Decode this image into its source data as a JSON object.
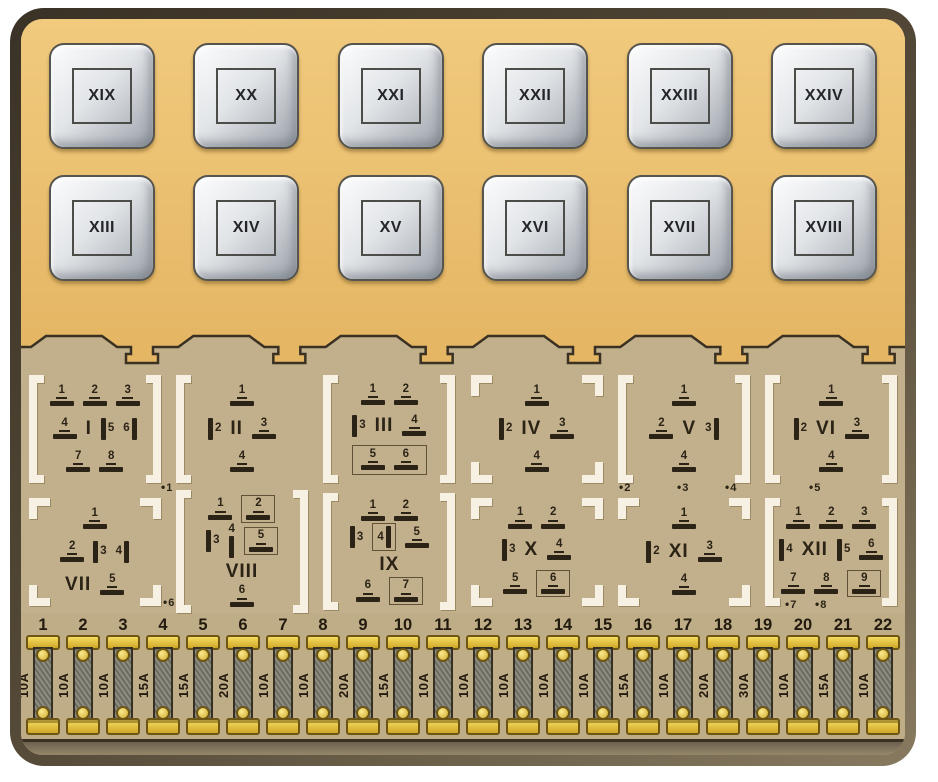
{
  "panel": {
    "relays": {
      "row1": [
        "XIX",
        "XX",
        "XXI",
        "XXII",
        "XXIII",
        "XXIV"
      ],
      "row2": [
        "XIII",
        "XIV",
        "XV",
        "XVI",
        "XVII",
        "XVIII"
      ]
    },
    "connectors": [
      {
        "label": "I",
        "bracket": "full",
        "rows": [
          {
            "pins": [
              {
                "n": "1"
              },
              {
                "n": "2"
              },
              {
                "n": "3"
              }
            ]
          },
          {
            "pins": [
              {
                "n": "4"
              },
              {
                "roman": true
              },
              {
                "n": "5",
                "v": "l"
              },
              {
                "n": "6",
                "v": "r"
              }
            ]
          },
          {
            "pins": [
              {
                "n": "7"
              },
              {
                "n": "8"
              }
            ]
          }
        ]
      },
      {
        "label": "II",
        "bracket": "left",
        "rows": [
          {
            "pins": [
              {
                "n": "1"
              }
            ]
          },
          {
            "pins": [
              {
                "n": "2",
                "v": "l"
              },
              {
                "roman": true
              },
              {
                "n": "3"
              }
            ]
          },
          {
            "pins": [
              {
                "n": "4"
              }
            ]
          }
        ]
      },
      {
        "label": "III",
        "bracket": "full",
        "rows": [
          {
            "pins": [
              {
                "n": "1"
              },
              {
                "n": "2"
              }
            ]
          },
          {
            "pins": [
              {
                "n": "3",
                "v": "l"
              },
              {
                "roman": true
              },
              {
                "n": "4"
              }
            ]
          },
          {
            "box": true,
            "pins": [
              {
                "n": "5"
              },
              {
                "n": "6"
              }
            ]
          }
        ]
      },
      {
        "label": "IV",
        "bracket": "corners",
        "rows": [
          {
            "pins": [
              {
                "n": "1"
              }
            ]
          },
          {
            "pins": [
              {
                "n": "2",
                "v": "l"
              },
              {
                "roman": true
              },
              {
                "n": "3"
              }
            ]
          },
          {
            "pins": [
              {
                "n": "4"
              }
            ]
          }
        ]
      },
      {
        "label": "V",
        "bracket": "full",
        "rows": [
          {
            "pins": [
              {
                "n": "1"
              }
            ]
          },
          {
            "pins": [
              {
                "n": "2"
              },
              {
                "roman": true
              },
              {
                "n": "3",
                "v": "r"
              }
            ]
          },
          {
            "pins": [
              {
                "n": "4"
              }
            ]
          }
        ]
      },
      {
        "label": "VI",
        "bracket": "full",
        "rows": [
          {
            "pins": [
              {
                "n": "1"
              }
            ]
          },
          {
            "pins": [
              {
                "n": "2",
                "v": "l"
              },
              {
                "roman": true
              },
              {
                "n": "3"
              }
            ]
          },
          {
            "pins": [
              {
                "n": "4"
              }
            ]
          }
        ]
      },
      {
        "label": "VII",
        "bracket": "corners",
        "rows": [
          {
            "pins": [
              {
                "n": "1"
              }
            ]
          },
          {
            "pins": [
              {
                "n": "2"
              },
              {
                "n": "3",
                "v": "l"
              },
              {
                "n": "4",
                "v": "r"
              }
            ]
          },
          {
            "pins": [
              {
                "roman": true
              },
              {
                "n": "5"
              }
            ]
          }
        ]
      },
      {
        "label": "VIII",
        "bracket": "full",
        "rows": [
          {
            "pins": [
              {
                "n": "1"
              },
              {
                "n": "2",
                "boxed": true
              }
            ]
          },
          {
            "pins": [
              {
                "n": "3",
                "v": "l"
              },
              {
                "n": "4",
                "v": "c"
              },
              {
                "n": "5",
                "boxed": true
              }
            ]
          },
          {
            "pins": [
              {
                "roman": true
              }
            ]
          },
          {
            "pins": [
              {
                "n": "6"
              }
            ]
          }
        ]
      },
      {
        "label": "IX",
        "bracket": "full",
        "rows": [
          {
            "pins": [
              {
                "n": "1"
              },
              {
                "n": "2"
              }
            ]
          },
          {
            "pins": [
              {
                "n": "3",
                "v": "l"
              },
              {
                "n": "4",
                "v": "r",
                "boxed": true
              },
              {
                "n": "5"
              }
            ]
          },
          {
            "pins": [
              {
                "roman": true
              }
            ]
          },
          {
            "pins": [
              {
                "n": "6"
              },
              {
                "n": "7",
                "boxed": true
              }
            ]
          }
        ]
      },
      {
        "label": "X",
        "bracket": "corners",
        "rows": [
          {
            "pins": [
              {
                "n": "1"
              },
              {
                "n": "2"
              }
            ]
          },
          {
            "pins": [
              {
                "n": "3",
                "v": "l"
              },
              {
                "roman": true
              },
              {
                "n": "4"
              }
            ]
          },
          {
            "pins": [
              {
                "n": "5"
              },
              {
                "n": "6",
                "boxed": true
              }
            ]
          }
        ]
      },
      {
        "label": "XI",
        "bracket": "corners",
        "rows": [
          {
            "pins": [
              {
                "n": "1"
              }
            ]
          },
          {
            "pins": [
              {
                "n": "2",
                "v": "l"
              },
              {
                "roman": true
              },
              {
                "n": "3"
              }
            ]
          },
          {
            "pins": [
              {
                "n": "4"
              }
            ]
          }
        ]
      },
      {
        "label": "XII",
        "bracket": "full",
        "rows": [
          {
            "pins": [
              {
                "n": "1"
              },
              {
                "n": "2"
              },
              {
                "n": "3"
              }
            ]
          },
          {
            "pins": [
              {
                "n": "4",
                "v": "l"
              },
              {
                "roman": true
              },
              {
                "n": "5",
                "v": "l"
              },
              {
                "n": "6"
              }
            ]
          },
          {
            "pins": [
              {
                "n": "7"
              },
              {
                "n": "8"
              },
              {
                "n": "9",
                "boxed": true
              }
            ]
          }
        ]
      }
    ],
    "markers": [
      {
        "label": "1",
        "x": 140,
        "y": 114
      },
      {
        "label": "2",
        "x": 598,
        "y": 114
      },
      {
        "label": "3",
        "x": 656,
        "y": 114
      },
      {
        "label": "4",
        "x": 704,
        "y": 114
      },
      {
        "label": "5",
        "x": 788,
        "y": 114
      },
      {
        "label": "6",
        "x": 142,
        "y": 229
      },
      {
        "label": "7",
        "x": 764,
        "y": 231
      },
      {
        "label": "8",
        "x": 794,
        "y": 231
      }
    ],
    "fuses": [
      {
        "n": "1",
        "amp": "10A"
      },
      {
        "n": "2",
        "amp": "10A"
      },
      {
        "n": "3",
        "amp": "10A"
      },
      {
        "n": "4",
        "amp": "15A"
      },
      {
        "n": "5",
        "amp": "15A"
      },
      {
        "n": "6",
        "amp": "20A"
      },
      {
        "n": "7",
        "amp": "10A"
      },
      {
        "n": "8",
        "amp": "10A"
      },
      {
        "n": "9",
        "amp": "20A"
      },
      {
        "n": "10",
        "amp": "15A"
      },
      {
        "n": "11",
        "amp": "10A"
      },
      {
        "n": "12",
        "amp": "10A"
      },
      {
        "n": "13",
        "amp": "10A"
      },
      {
        "n": "14",
        "amp": "10A"
      },
      {
        "n": "15",
        "amp": "10A"
      },
      {
        "n": "16",
        "amp": "15A"
      },
      {
        "n": "17",
        "amp": "10A"
      },
      {
        "n": "18",
        "amp": "20A"
      },
      {
        "n": "19",
        "amp": "30A"
      },
      {
        "n": "20",
        "amp": "10A"
      },
      {
        "n": "21",
        "amp": "15A"
      },
      {
        "n": "22",
        "amp": "10A"
      }
    ]
  },
  "colors": {
    "frame_dark": "#3a3226",
    "frame_mid": "#564b39",
    "frame_light": "#877a5f",
    "top_bg_1": "#f1ca7e",
    "top_bg_2": "#e5b765",
    "mid_bg": "#c2b08c",
    "fuse_bg": "#bead87",
    "bottom_strip_1": "#6d6150",
    "bottom_strip_2": "#958769",
    "relay_border": "#55544e",
    "pin": "#2b2316",
    "bracket": "#f6f1e2",
    "outline": "#3a3122",
    "fuse_yellow_1": "#f5dd62",
    "fuse_yellow_2": "#cfa827",
    "fuse_metal_edge": "#6d5514",
    "fuse_body_1": "#6c6c63",
    "fuse_body_2": "#8d8d82"
  }
}
